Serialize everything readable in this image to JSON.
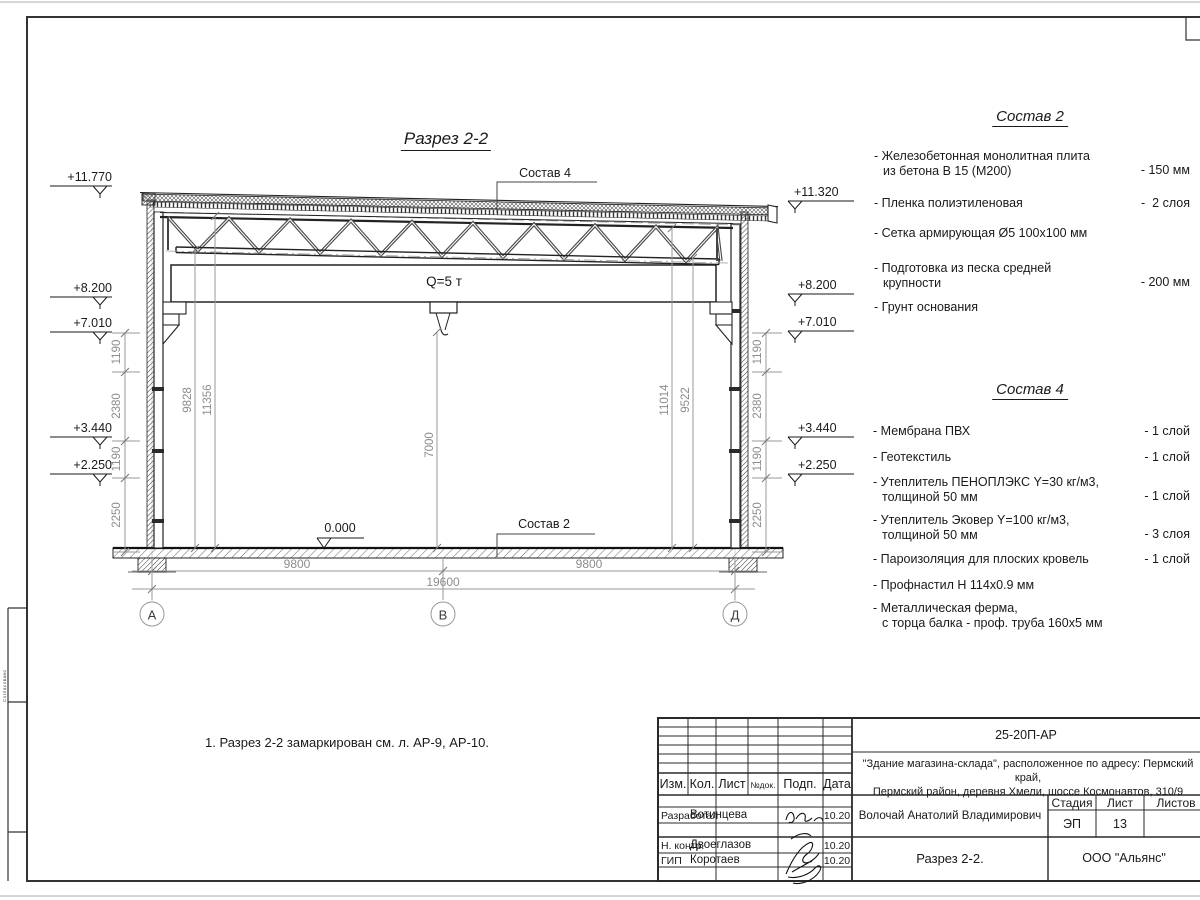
{
  "section": {
    "title": "Разрез 2-2",
    "crane": "Q=5 т",
    "zero": "0.000",
    "comp4_ref": "Состав 4",
    "comp2_ref": "Состав 2"
  },
  "axes": {
    "a": "А",
    "b": "В",
    "d": "Д"
  },
  "levels": {
    "left": [
      "+11.770",
      "+8.200",
      "+7.010",
      "+3.440",
      "+2.250"
    ],
    "right": [
      "+11.320",
      "+8.200",
      "+7.010",
      "+3.440",
      "+2.250"
    ]
  },
  "dims": {
    "left_chain": [
      "1190",
      "2380",
      "1190",
      "2250"
    ],
    "right_chain": [
      "1190",
      "2380",
      "1190",
      "2250"
    ],
    "inner": {
      "d9828": "9828",
      "d11356": "11356",
      "d7000": "7000",
      "d11014": "11014",
      "d9522": "9522"
    },
    "bottom": {
      "left": "9800",
      "right": "9800",
      "total": "19600"
    }
  },
  "note": "1. Разрез 2-2 замаркирован см. л. АР-9, АР-10.",
  "comp2": {
    "title": "Состав 2",
    "items": [
      {
        "name": "- Железобетонная  монолитная плита\nиз бетона В 15 (М200)",
        "value": "- 150 мм"
      },
      {
        "name": "- Пленка полиэтиленовая",
        "value": "-  2 слоя"
      },
      {
        "name": "- Сетка армирующая Ø5 100х100 мм",
        "value": ""
      },
      {
        "name": "- Подготовка из песка средней\nкрупности",
        "value": "- 200 мм"
      },
      {
        "name": "- Грунт основания",
        "value": ""
      }
    ]
  },
  "comp4": {
    "title": "Состав 4",
    "items": [
      {
        "name": "- Мембрана ПВХ",
        "value": "- 1 слой"
      },
      {
        "name": "- Геотекстиль",
        "value": "- 1 слой"
      },
      {
        "name": "- Утеплитель ПЕНОПЛЭКС Y=30 кг/м3,\nтолщиной 50 мм",
        "value": "- 1 слой"
      },
      {
        "name": "- Утеплитель Эковер Y=100 кг/м3,\nтолщиной 50 мм",
        "value": "- 3 слоя"
      },
      {
        "name": "- Пароизоляция для плоских кровель",
        "value": "- 1 слой"
      },
      {
        "name": "- Профнастил Н 114х0.9 мм",
        "value": ""
      },
      {
        "name": "- Металлическая ферма,\nс торца балка - проф. труба 160х5 мм",
        "value": ""
      }
    ]
  },
  "titleblock": {
    "doc_number": "25-20П-АР",
    "project": "\"Здание магазина-склада\", расположенное по адресу: Пермский край,\nПермский район, деревня Хмели, шоссе Космонавтов, 310/9",
    "cols": {
      "izm": "Изм.",
      "kol": "Кол.",
      "list": "Лист",
      "ndok": "№док.",
      "podp": "Подп.",
      "data": "Дата"
    },
    "rows": [
      {
        "role": "Разработал",
        "name": "Вотинцева",
        "date": "10.20"
      },
      {
        "role": "Н. контр.",
        "name": "Двоеглазов",
        "date": "10.20"
      },
      {
        "role": "ГИП",
        "name": "Коротаев",
        "date": "10.20"
      }
    ],
    "chief": "Волочай Анатолий Владимирович",
    "stage_label": "Стадия",
    "sheet_label": "Лист",
    "sheets_label": "Листов",
    "stage": "ЭП",
    "sheet": "13",
    "drawing_name": "Разрез 2-2.",
    "company": "ООО \"Альянс\""
  },
  "sheet": {
    "margin_text": "Согласовано"
  }
}
